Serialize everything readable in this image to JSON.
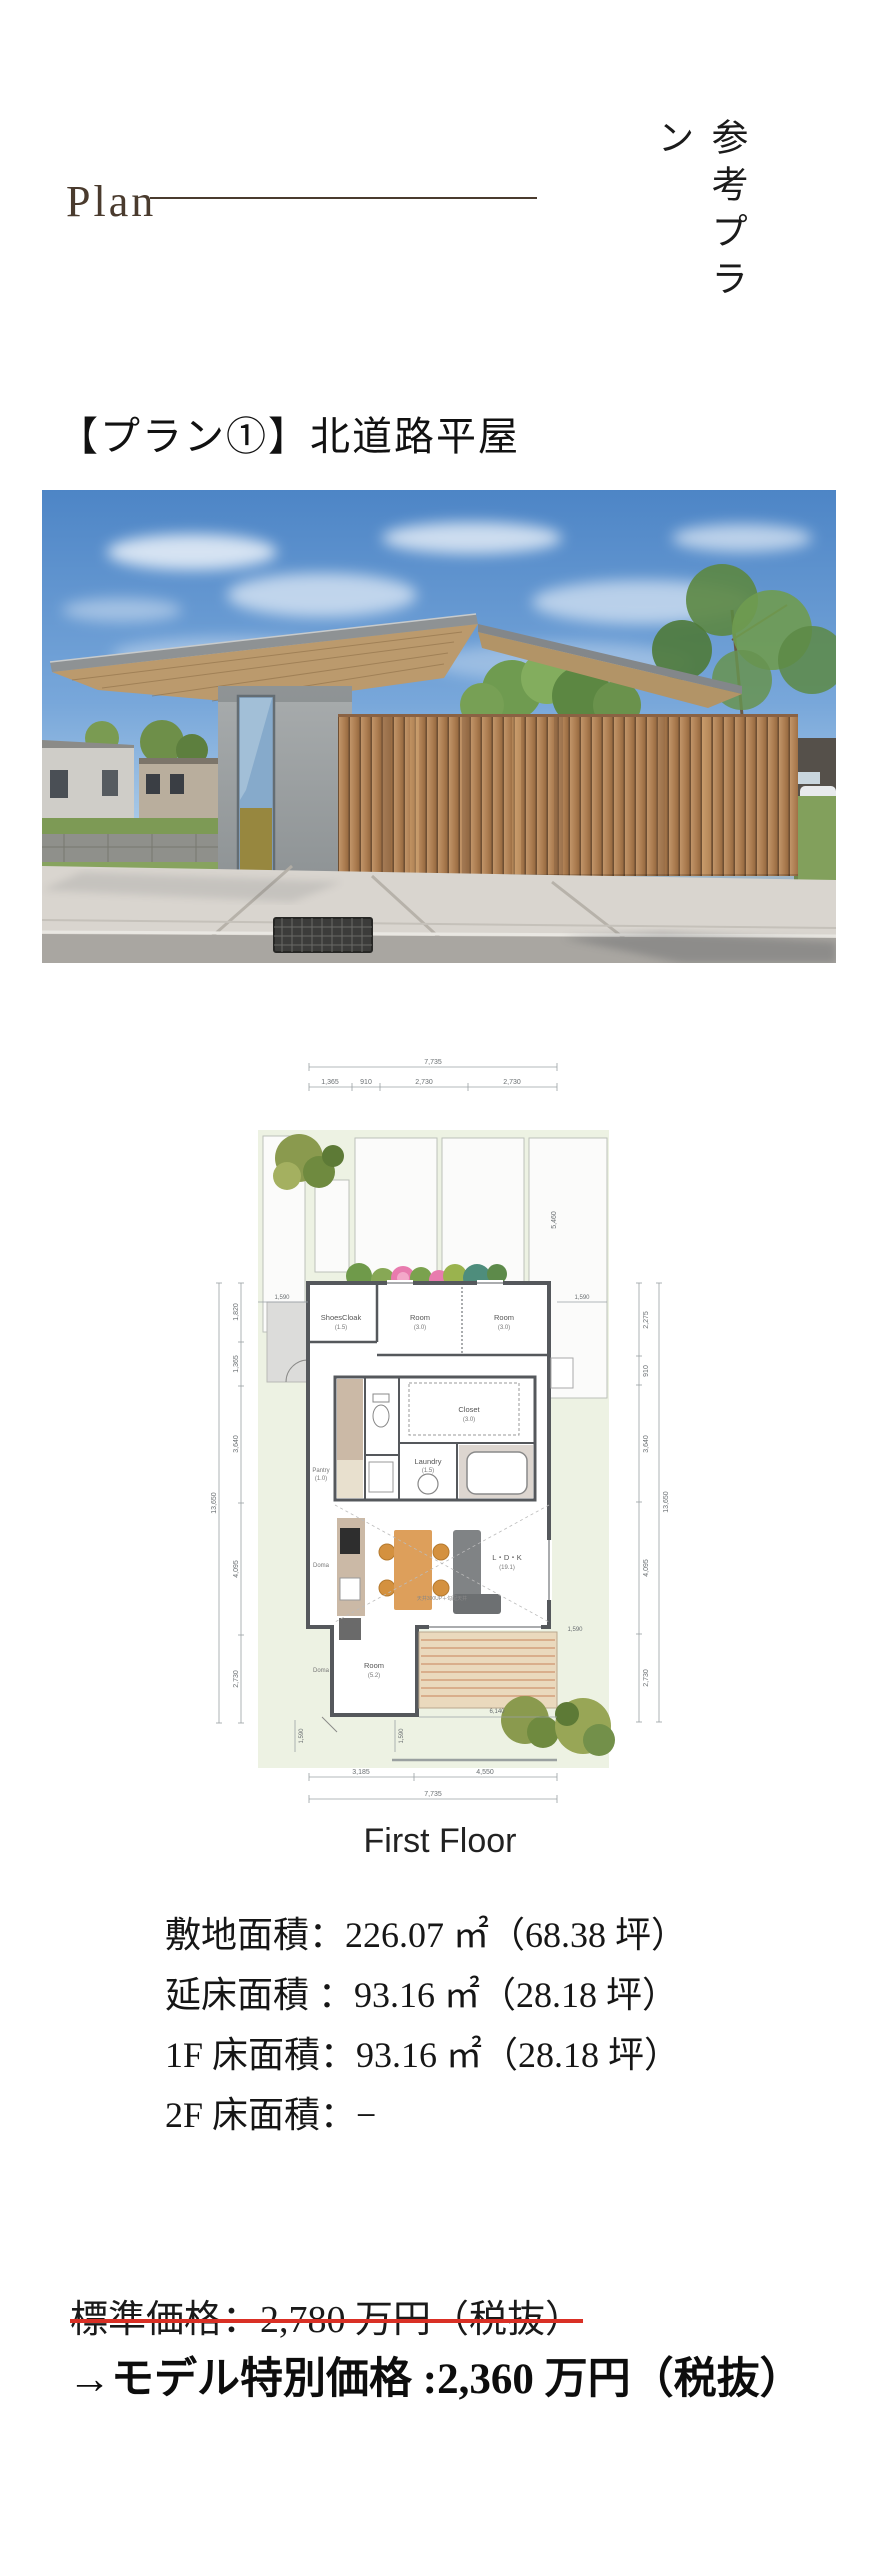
{
  "header": {
    "plan_label": "Plan",
    "vertical_title": "参考プラン"
  },
  "section_heading": "【プラン①】北道路平屋",
  "photo": {
    "description": "north-road single-story house exterior render"
  },
  "floor_plan": {
    "caption": "First Floor",
    "ceiling_note": "天井300UP＋勾配天井",
    "rooms": {
      "shoes_cloak": {
        "label": "ShoesCloak",
        "size": "(1.5)"
      },
      "room1": {
        "label": "Room",
        "size": "(3.0)"
      },
      "room2": {
        "label": "Room",
        "size": "(3.0)"
      },
      "closet": {
        "label": "Closet",
        "size": "(3.0)"
      },
      "laundry": {
        "label": "Laundry",
        "size": "(1.5)"
      },
      "pantry": {
        "label": "Pantry",
        "size": "(1.0)"
      },
      "doma_upper": {
        "label": "Doma"
      },
      "doma_lower": {
        "label": "Doma"
      },
      "room3": {
        "label": "Room",
        "size": "(5.2)"
      },
      "ldk": {
        "label": "L・D・K",
        "size": "(19.1)"
      }
    },
    "dims": {
      "top_total": "7,735",
      "top_1": "1,365",
      "top_2": "910",
      "top_3": "2,730",
      "top_4": "2,730",
      "left_1": "1,820",
      "left_2": "1,365",
      "left_3": "3,640",
      "left_4": "4,095",
      "left_5": "2,730",
      "left_total": "13,650",
      "right_1": "2,275",
      "right_2": "910",
      "right_3": "3,640",
      "right_4": "4,095",
      "right_5": "2,730",
      "right_total": "13,650",
      "bottom_1": "3,185",
      "bottom_2": "4,550",
      "bottom_total": "7,735",
      "inner_height": "5,460",
      "side_left": "1,590",
      "side_right": "1,590",
      "porch_1": "1,590",
      "porch_2": "1,590",
      "deck_width": "6,140",
      "gate": "1,590"
    }
  },
  "specs": {
    "lines": [
      "敷地面積：226.07 ㎡（68.38 坪）",
      "延床面積 ：93.16 ㎡（28.18 坪）",
      "1F 床面積：93.16 ㎡（28.18 坪）",
      "2F 床面積：−"
    ]
  },
  "pricing": {
    "standard_price": "標準価格：2,780 万円（税抜）",
    "special_price": "→モデル特別価格 :2,360 万円（税抜）"
  },
  "colors": {
    "accent_brown": "#4a3b2e",
    "strike_red": "#d93025",
    "site_green": "#edf2e3",
    "fence_wood": "#b0825a"
  }
}
